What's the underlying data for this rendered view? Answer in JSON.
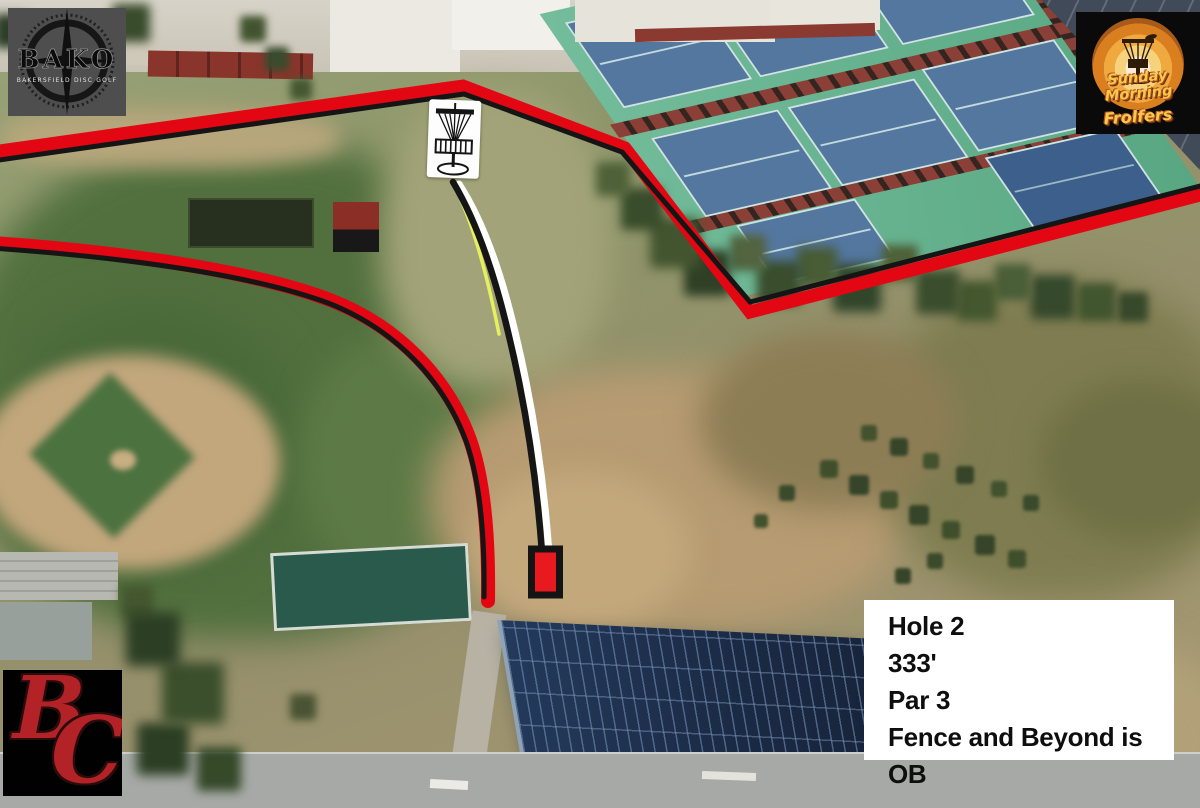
{
  "hole_info": {
    "hole": "Hole 2",
    "distance": "333'",
    "par": "Par 3",
    "rule": "Fence and Beyond is OB"
  },
  "logos": {
    "bako": {
      "title": "BAKO",
      "subtitle": "BAKERSFIELD DISC GOLF"
    },
    "frolfers": {
      "line1": "Sunday Morning",
      "line2": "Frolfers"
    },
    "bc": {
      "b": "B",
      "c": "C"
    }
  },
  "icons": {
    "basket": "disc-golf-basket-icon",
    "compass": "compass-rose-icon",
    "sun": "retro-sunset-icon"
  },
  "colors": {
    "ob_line": "#e30613",
    "line_casing": "#151515",
    "flight_path": "#ffffff",
    "flight_path_alt": "#e6f05e",
    "tee_pad": "#e8191f",
    "info_text": "#0e0e0e"
  }
}
